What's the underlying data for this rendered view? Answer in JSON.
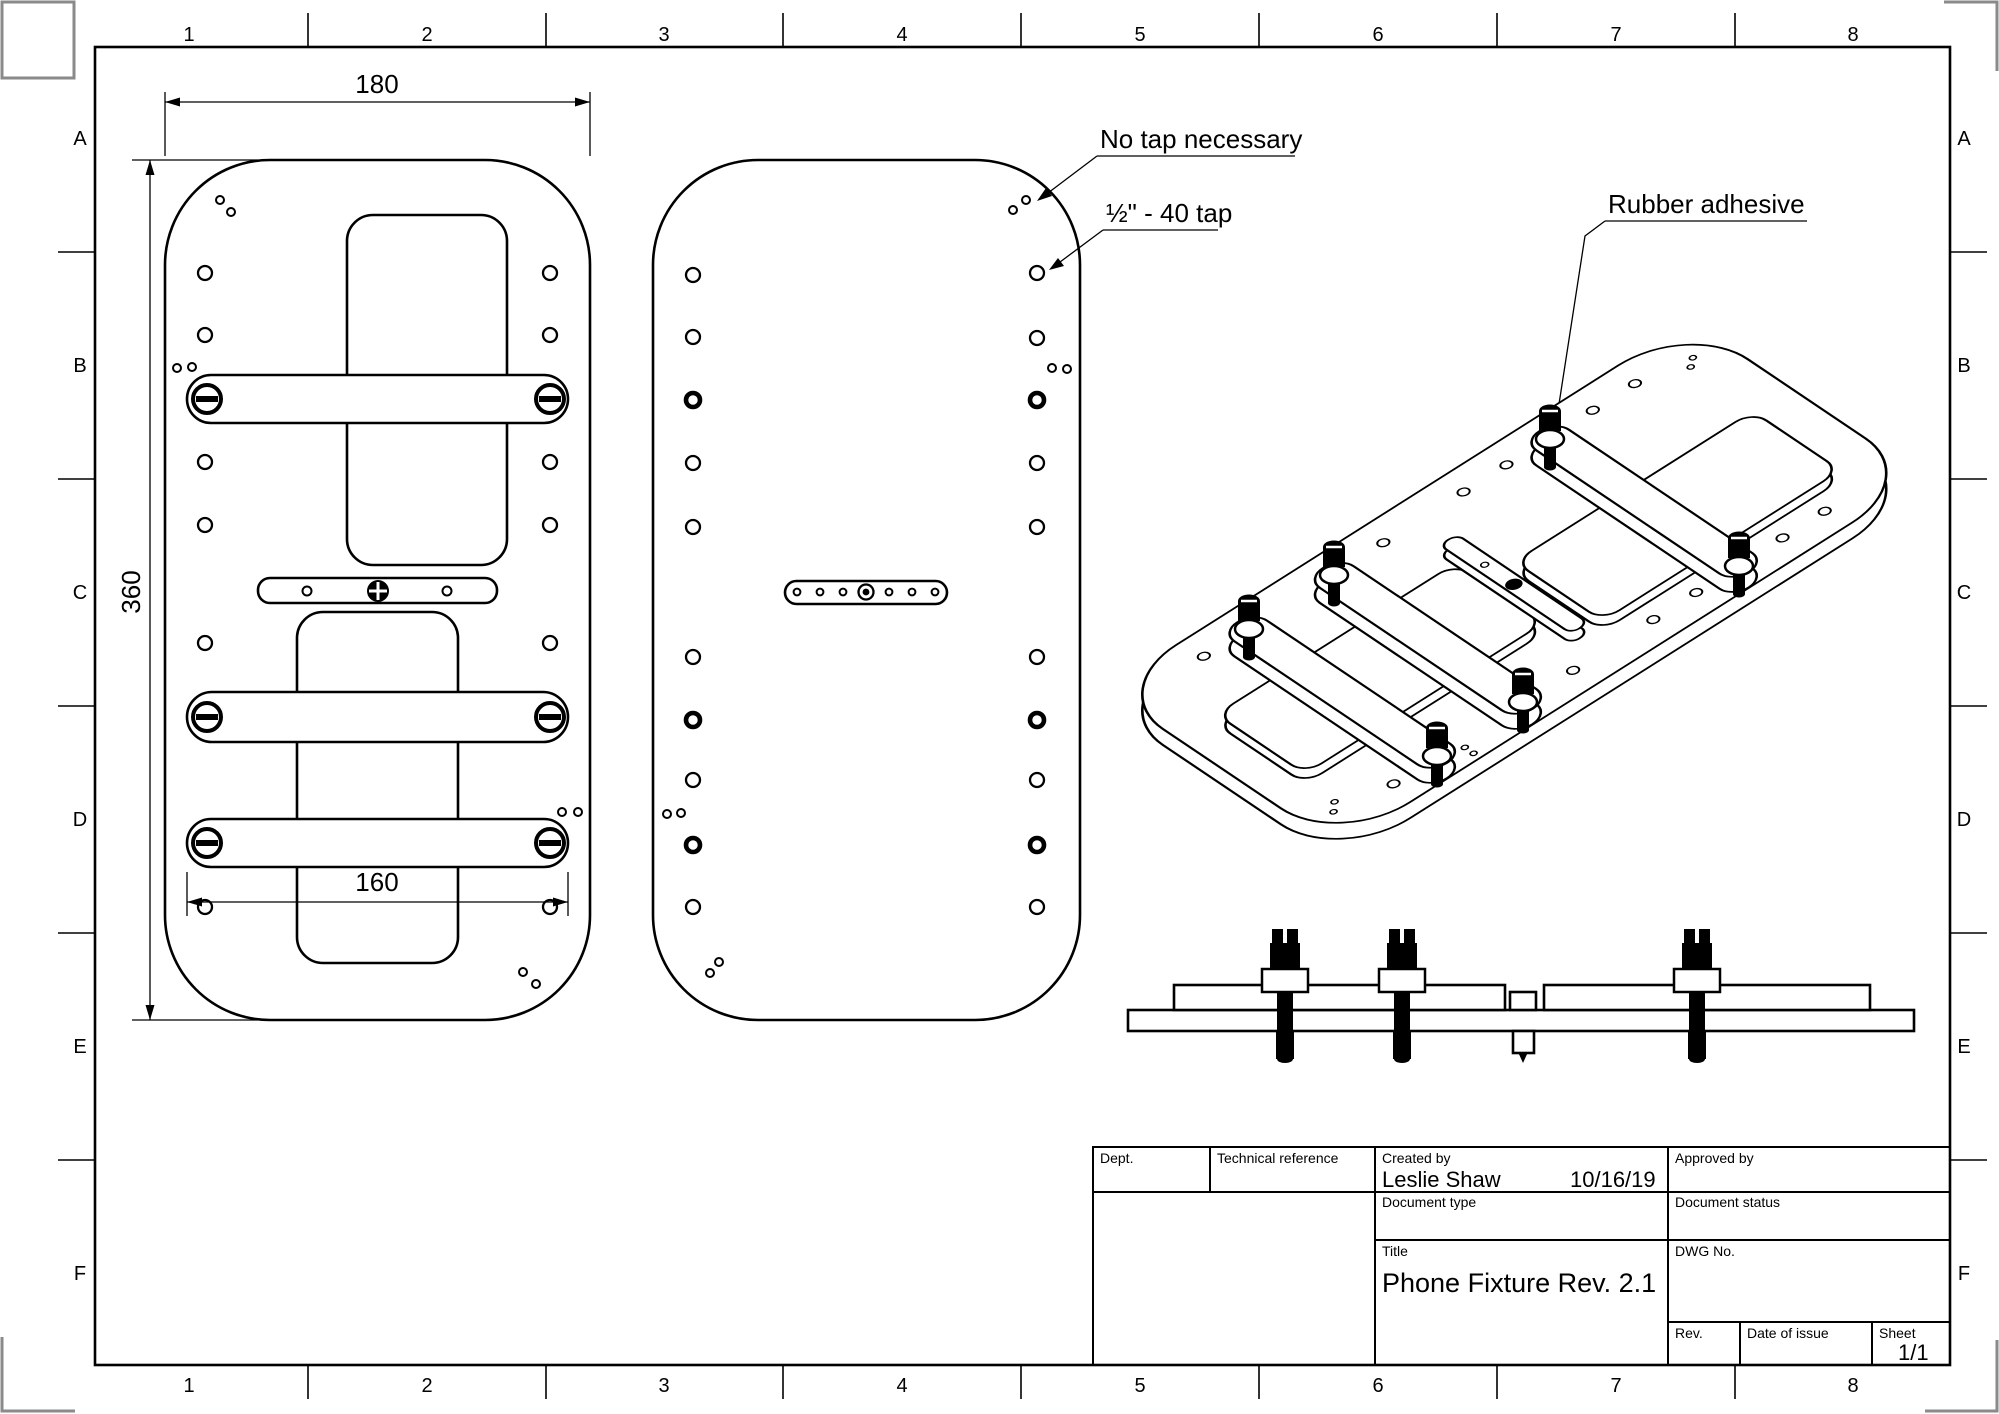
{
  "colors": {
    "line": "#000000",
    "background": "#ffffff",
    "trim_mark": "#8a8a8a"
  },
  "frame": {
    "columns": [
      "1",
      "2",
      "3",
      "4",
      "5",
      "6",
      "7",
      "8"
    ],
    "rows": [
      "A",
      "B",
      "C",
      "D",
      "E",
      "F"
    ]
  },
  "dimensions": {
    "plate_width": "180",
    "plate_height": "360",
    "bar_length": "160"
  },
  "annotations": {
    "no_tap": "No tap necessary",
    "tap": "½\" - 40 tap",
    "rubber_adhesive": "Rubber adhesive"
  },
  "title_block": {
    "dept_label": "Dept.",
    "technical_reference_label": "Technical reference",
    "created_by_label": "Created by",
    "created_by_name": "Leslie Shaw",
    "created_date": "10/16/19",
    "approved_by_label": "Approved by",
    "document_type_label": "Document type",
    "document_status_label": "Document status",
    "title_label": "Title",
    "title": "Phone Fixture Rev. 2.1",
    "dwg_no_label": "DWG No.",
    "rev_label": "Rev.",
    "date_of_issue_label": "Date of issue",
    "sheet_label": "Sheet",
    "sheet_value": "1/1"
  }
}
